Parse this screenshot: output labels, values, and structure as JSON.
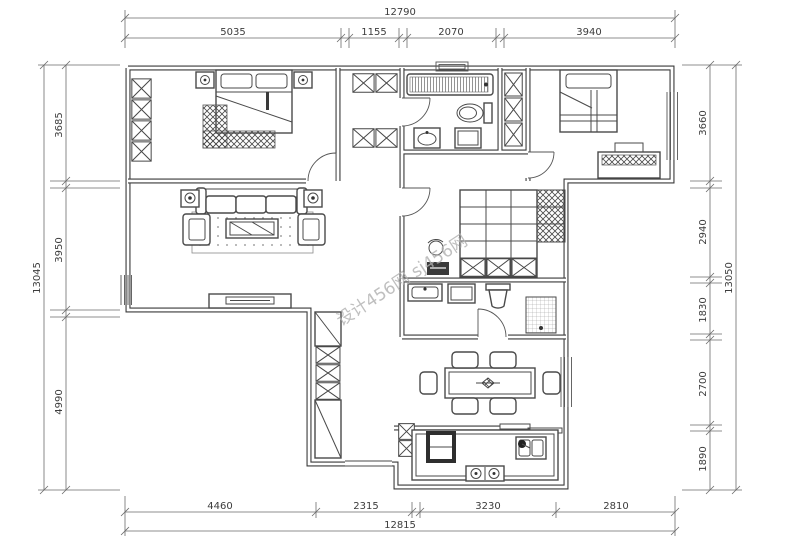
{
  "dims": {
    "top": {
      "total": "12790",
      "segments": [
        "5035",
        "1155",
        "2070",
        "3940"
      ]
    },
    "bottom": {
      "total": "12815",
      "segments": [
        "4460",
        "2315",
        "3230",
        "2810"
      ]
    },
    "left": {
      "total": "13045",
      "segments": [
        "3685",
        "3950",
        "4990"
      ]
    },
    "right": {
      "total": "13050",
      "segments": [
        "3660",
        "2940",
        "1830",
        "2700",
        "1890"
      ]
    }
  },
  "watermark": {
    "text": "设计456网 sj456网"
  }
}
